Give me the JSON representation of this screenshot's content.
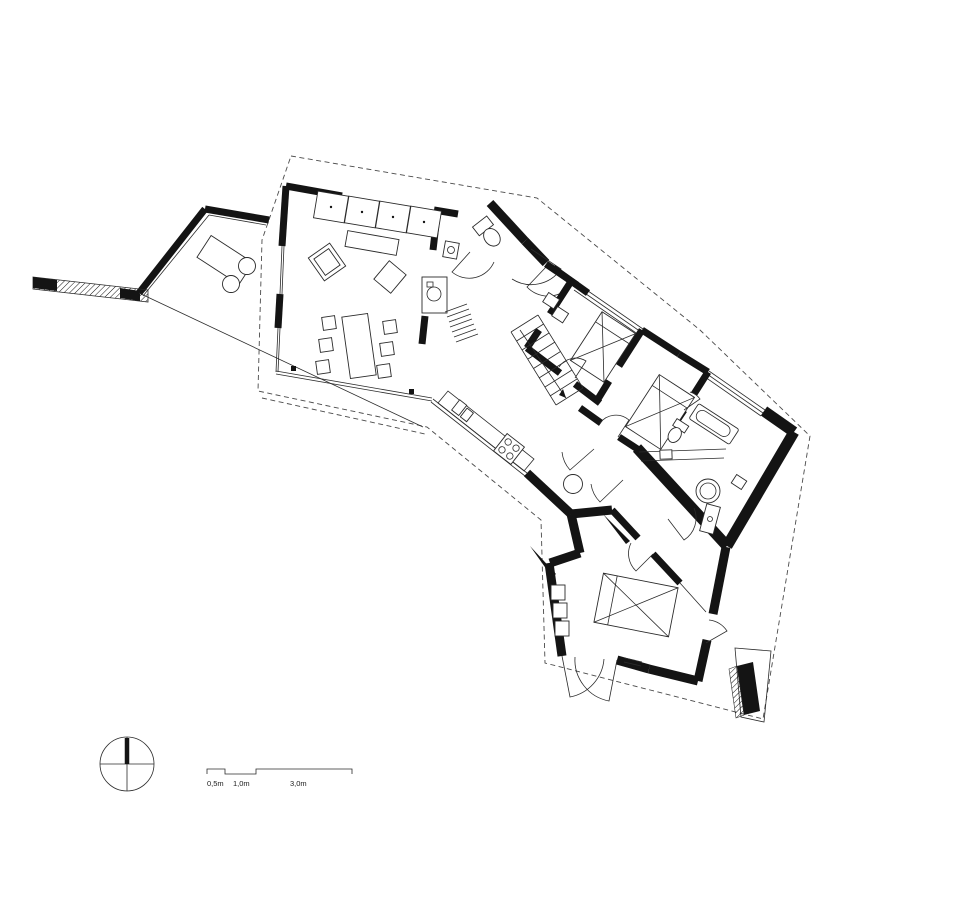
{
  "page": {
    "background_color": "#ffffff",
    "ink_color": "#141414"
  },
  "scale_bar": {
    "labels": [
      "0,5m",
      "1,0m",
      "3,0m"
    ]
  },
  "compass": {
    "icon": "north-arrow-compass-icon"
  },
  "plan_symbols": {
    "icons": [
      "sofa-symbol",
      "coffee-table-symbol",
      "armchair-symbol",
      "dining-table-symbol",
      "chair-symbol",
      "kitchen-counter-symbol",
      "sink-symbol",
      "cooktop-symbol",
      "bed-symbol",
      "bathtub-symbol",
      "toilet-symbol",
      "washbasin-symbol",
      "shower-symbol",
      "stairs-symbol",
      "door-swing-symbol",
      "wardrobe-symbol",
      "washing-machine-symbol",
      "outdoor-table-symbol",
      "entry-path-hatch",
      "site-boundary-dashed"
    ]
  }
}
